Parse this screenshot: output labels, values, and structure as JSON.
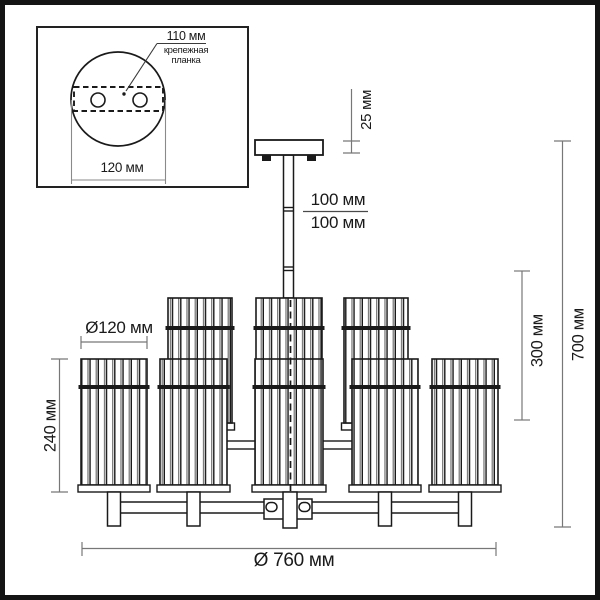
{
  "drawing_title": "chandelier dimension drawing",
  "inset": {
    "hole_spacing": "110 мм",
    "bracket_line1": "крепежная",
    "bracket_line2": "планка",
    "plate_width": "120 мм"
  },
  "dims": {
    "canopy_height": "25 мм",
    "rod_section_1": "100 мм",
    "rod_section_2": "100 мм",
    "body_drop": "300 мм",
    "total_height": "700 мм",
    "shade_height": "240 мм",
    "shade_diameter": "Ø120 мм",
    "fixture_diameter": "Ø 760 мм"
  },
  "colors": {
    "line": "#1a1a1a",
    "dim_line": "#777777",
    "background": "#ffffff"
  }
}
